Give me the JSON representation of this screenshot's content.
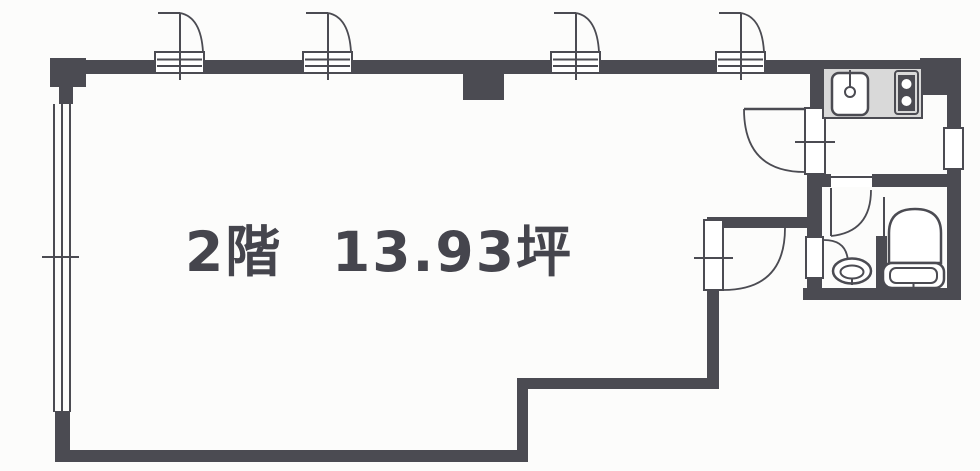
{
  "floor_plan": {
    "title": {
      "floor": "2階",
      "area": "13.93坪"
    },
    "colors": {
      "wall": "#4b4b52",
      "counter": "#d9d9d9",
      "background": "#fcfcfb",
      "text": "#45454d",
      "fixture_fill": "#ffffff"
    },
    "legend": {
      "fixtures": [
        "kitchen-sink",
        "gas-stove",
        "wash-basin",
        "toilet"
      ],
      "doors": [
        "entry-door-1",
        "entry-door-2",
        "entry-door-3",
        "entry-door-4",
        "kitchen-door",
        "hallway-door",
        "washroom-door"
      ],
      "windows": [
        "left-window",
        "right-window"
      ]
    }
  }
}
